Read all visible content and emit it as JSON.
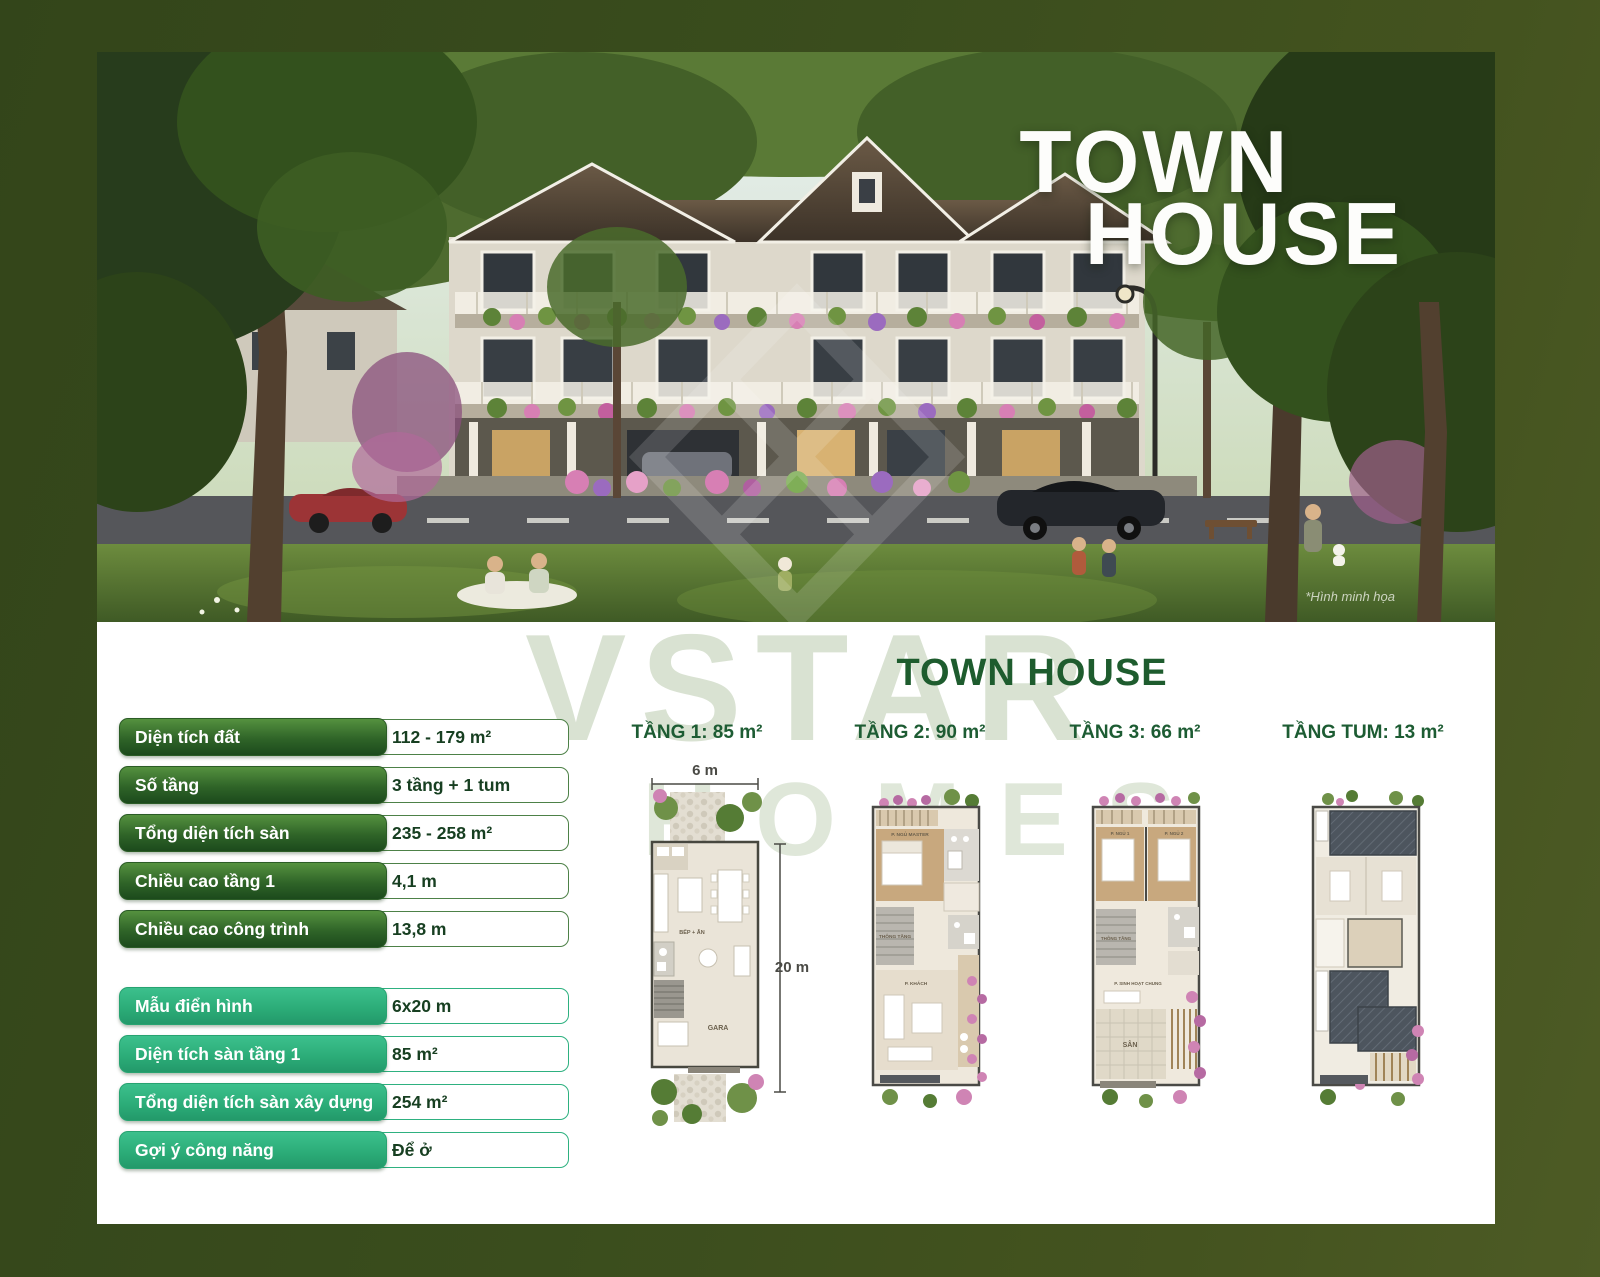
{
  "hero": {
    "title_line1": "TOWN",
    "title_line2": "HOUSE",
    "caption": "*Hình minh họa"
  },
  "watermark": {
    "line1": "VSTAR",
    "line2": "HOMES"
  },
  "panel": {
    "title": "TOWN HOUSE",
    "specs_group1": [
      {
        "label": "Diện tích đất",
        "value": "112 - 179 m²"
      },
      {
        "label": "Số tầng",
        "value": "3 tầng + 1 tum"
      },
      {
        "label": "Tổng diện tích sàn",
        "value": "235 - 258 m²"
      },
      {
        "label": "Chiều cao tầng 1",
        "value": "4,1 m"
      },
      {
        "label": "Chiều cao công trình",
        "value": "13,8 m"
      }
    ],
    "specs_group2": [
      {
        "label": "Mẫu điển hình",
        "value": "6x20 m"
      },
      {
        "label": "Diện tích sàn tầng 1",
        "value": "85 m²"
      },
      {
        "label": "Tổng diện tích sàn xây dựng",
        "value": "254 m²"
      },
      {
        "label": "Gợi ý công năng",
        "value": "Để ở"
      }
    ],
    "floors": [
      {
        "label": "TẦNG 1: 85 m²",
        "dim_width": "6 m",
        "dim_height": "20 m",
        "rooms": [
          "BẾP + ĂN",
          "GARA"
        ]
      },
      {
        "label": "TẦNG 2: 90 m²",
        "rooms": [
          "P. NGỦ MASTER",
          "THÔNG TẦNG",
          "P. KHÁCH"
        ]
      },
      {
        "label": "TẦNG 3: 66 m²",
        "rooms": [
          "P. NGỦ 1",
          "P. NGỦ 2",
          "THÔNG TẦNG",
          "P. SINH HOẠT CHUNG",
          "SÂN"
        ]
      },
      {
        "label": "TẦNG TUM: 13 m²",
        "rooms": []
      }
    ]
  },
  "colors": {
    "page_bg": "#3a4d1d",
    "accent_dark_green": "#1e5c2e",
    "spec_pill_dark": "#2f6428",
    "spec_pill_emerald": "#2bab77",
    "spec_value_text": "#173f21",
    "watermark_green": "#aabf9c",
    "hero_title_white": "#fdfdfb"
  }
}
